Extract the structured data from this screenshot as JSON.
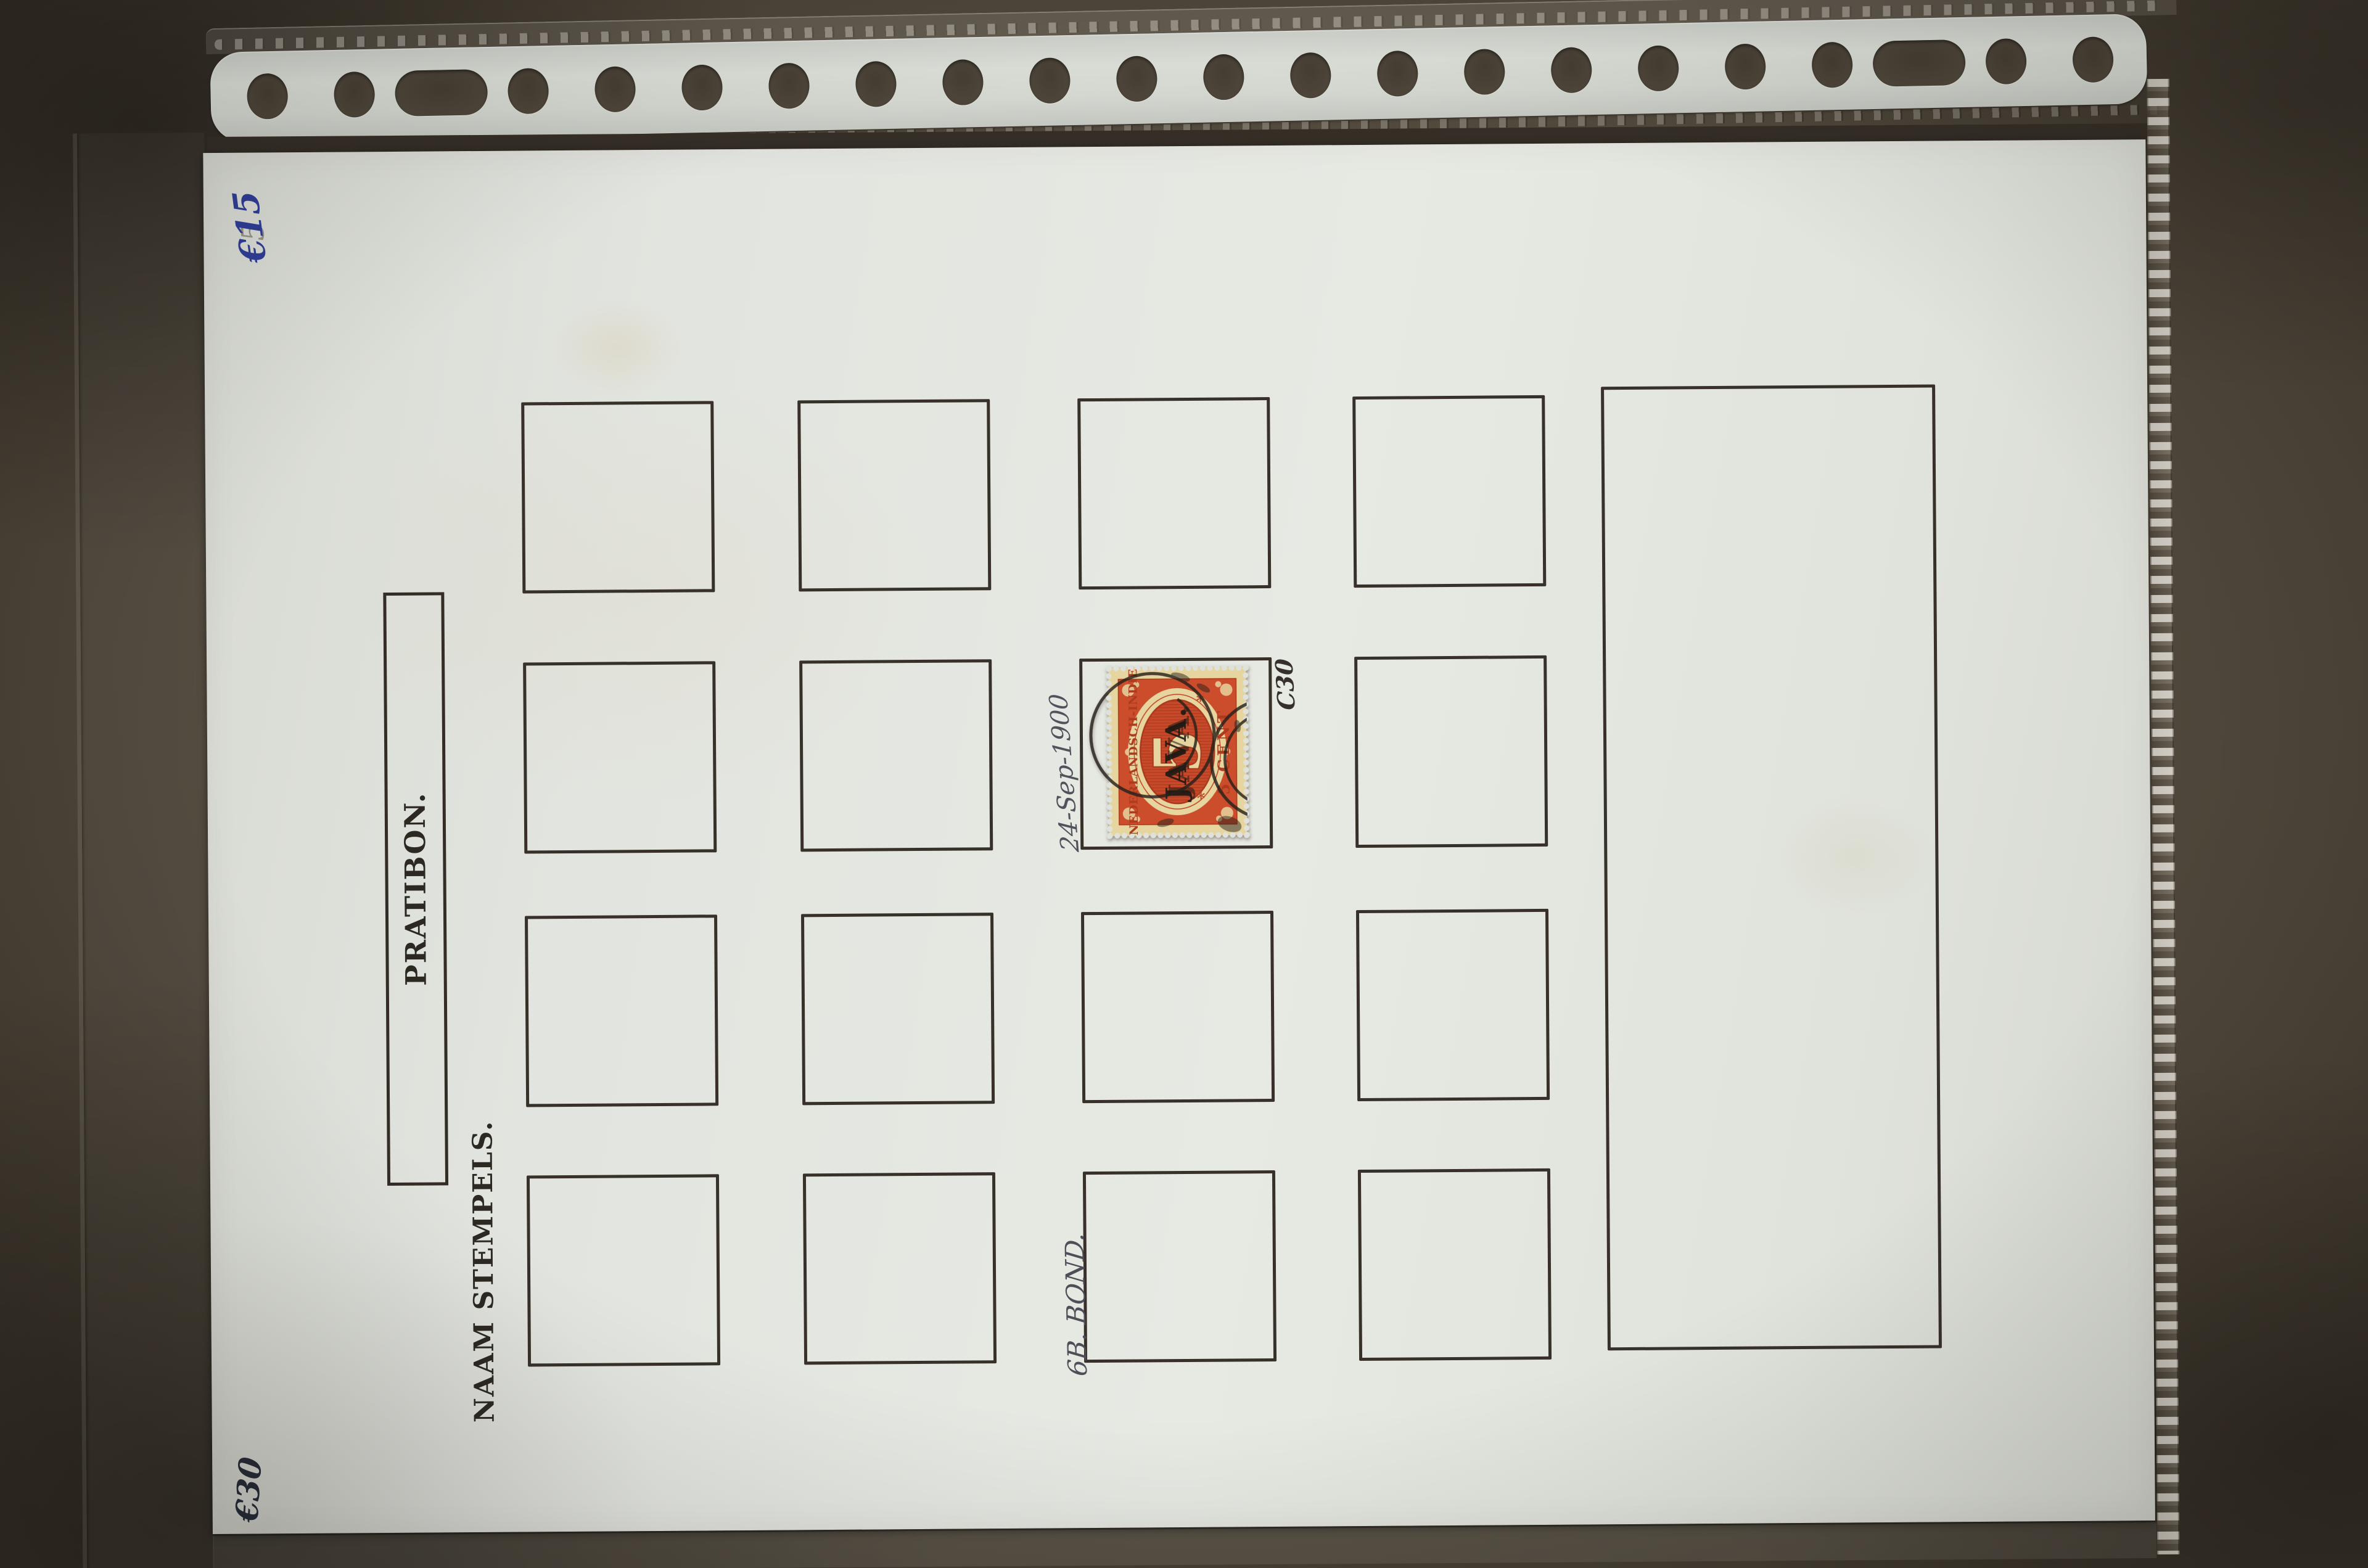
{
  "page": {
    "title": "PRATIBON.",
    "subtitle": "NAAM STEMPELS.",
    "grid": {
      "rows": 4,
      "columns": 4,
      "small_frames": 16,
      "large_frames": 1
    }
  },
  "annotations": {
    "price_top_left": "€15",
    "pencil_top_left": "5",
    "price_bottom_left": "€30",
    "date_note": "24-Sep-1900",
    "catalog_note": "C30",
    "bond_note": "6B. BOND."
  },
  "stamp": {
    "country": "NEDERLANDSCH-INDIE",
    "denomination_numeral": "5",
    "denomination_text": "5 CENT",
    "overprint": "JAVA.",
    "colors": {
      "paper": "#e8d6a0",
      "ink": "#cc4d2b",
      "cancel": "#27211a"
    }
  },
  "colors": {
    "background": "#4a4237",
    "sleeve_strip": "#d4d7d0",
    "album_page": "#e2e4df",
    "frame_lines": "#37312a",
    "handwriting_blue": "#2f3d96",
    "handwriting_dark": "#3f3f49"
  }
}
